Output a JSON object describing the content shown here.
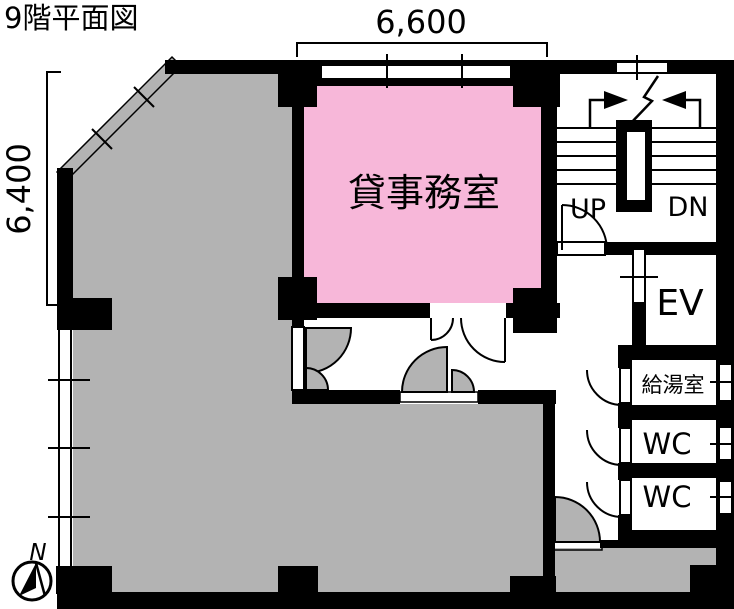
{
  "title": "9階平面図",
  "dimensions": {
    "top_width": "6,600",
    "left_height": "6,400"
  },
  "rooms": {
    "office_label": "貸事務室",
    "kitchenette_label": "給湯室",
    "wc_upper_label": "WC",
    "wc_lower_label": "WC",
    "elevator_label": "EV"
  },
  "stairs": {
    "up_label": "UP",
    "down_label": "DN"
  },
  "compass": {
    "north_label": "N"
  },
  "colors": {
    "office_fill": "#F7B7D9",
    "tenant_fill": "#B3B3B3",
    "wall": "#000000",
    "background": "#FFFFFF"
  }
}
